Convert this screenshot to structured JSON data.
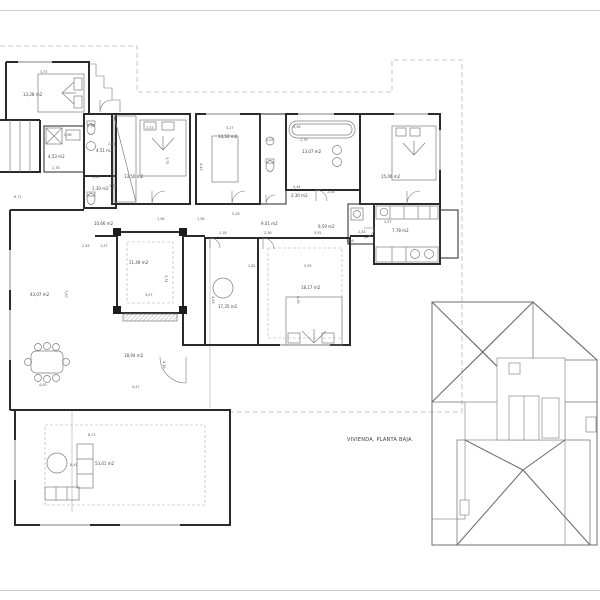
{
  "title_block": {
    "label": "VIVIENDA. PLANTA BAJA."
  },
  "colors": {
    "ink": "#2b2b2b",
    "detail": "#777777",
    "hatch": "#9c9c9c",
    "overhang_dash": "#b8b8b8",
    "frame": "#cbcbcb",
    "paper": "#ffffff"
  },
  "drawing": {
    "type": "architectural-floor-plan-with-roof-plan",
    "rooms": [
      {
        "name": "bedroom-1",
        "area": "13,28 m2"
      },
      {
        "name": "bath-1",
        "area": "4,53 m2"
      },
      {
        "name": "bath-2",
        "area": "4,51 m2"
      },
      {
        "name": "wc-1",
        "area": "2,30 m2"
      },
      {
        "name": "bedroom-2",
        "area": "13,50 m2"
      },
      {
        "name": "bedroom-3",
        "area": "14,50 m2"
      },
      {
        "name": "bathroom-main",
        "area": "13,07 m2"
      },
      {
        "name": "bedroom-4",
        "area": "15,06 m2"
      },
      {
        "name": "hall",
        "area": "10,66 m2"
      },
      {
        "name": "corridor-1",
        "area": "9,01 m2"
      },
      {
        "name": "corridor-2",
        "area": "9,59 m2"
      },
      {
        "name": "patio",
        "area": "11,49 m2"
      },
      {
        "name": "living-dining",
        "area": "43,07 m2"
      },
      {
        "name": "study",
        "area": "17,35 m2"
      },
      {
        "name": "bedroom-5",
        "area": "18,17 m2"
      },
      {
        "name": "porch",
        "area": "18,94 m2"
      },
      {
        "name": "kitchen",
        "area": "7,78 m2"
      },
      {
        "name": "terrace",
        "area": "53,01 m2"
      },
      {
        "name": "wc-2",
        "area": "2,30 m2"
      }
    ],
    "dims": [
      "3,75",
      "2,43",
      "3,27",
      "4,38",
      "2,05",
      "2,79",
      "1,78",
      "2,41",
      "0,98",
      "2,78",
      "3,75",
      "4,43",
      "1,62",
      "1,44",
      "4,44",
      "1,08",
      "6,71",
      "1,06",
      "5,28",
      "1,98",
      "2,18",
      "2,36",
      "3,92",
      "2,82",
      "2,95",
      "4,59",
      "4,56",
      "2,43",
      "1,27",
      "3,74",
      "3,07",
      "7,60",
      "4,00",
      "4,47",
      "4,36",
      "8,73",
      "8,41",
      "2,57",
      "2,43",
      "1,56"
    ]
  }
}
